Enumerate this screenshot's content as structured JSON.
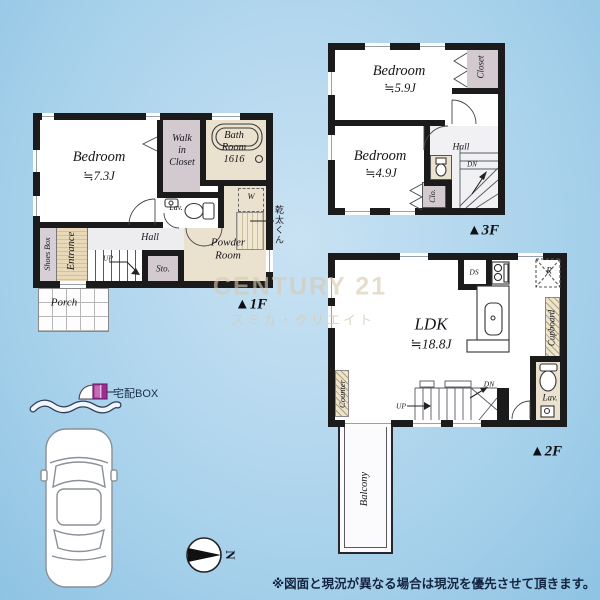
{
  "colors": {
    "background_top": "#b3d7ee",
    "background_bottom": "#8ec3e2",
    "wall": "#1b1b1b",
    "room_beige": "#eae2cf",
    "room_mauve": "#d3cad0",
    "hall_gray": "#ededf0",
    "watermark_beige": "#d8cab0",
    "delivery_magenta": "#9b2d93",
    "text_navy": "#152440"
  },
  "floors": {
    "f1": {
      "marker": "▲1F",
      "bedroom": [
        "Bedroom",
        "≒7.3J"
      ],
      "walk_in_closet": [
        "Walk",
        "in",
        "Closet"
      ],
      "bath": [
        "Bath",
        "Room",
        "1616"
      ],
      "lav": "Lav.",
      "washer": "W",
      "dryer": "乾太くん",
      "powder": [
        "Powder",
        "Room"
      ],
      "hall": "Hall",
      "up": "UP",
      "storage": "Sto.",
      "shoes_box": "Shoes Box",
      "entrance": "Entrance",
      "porch": "Porch"
    },
    "f3": {
      "marker": "▲3F",
      "bedroom1": [
        "Bedroom",
        "≒5.9J"
      ],
      "closet": "Closet",
      "bedroom2": [
        "Bedroom",
        "≒4.9J"
      ],
      "hall": "Hall",
      "dn": "DN",
      "clo": "Clo."
    },
    "f2": {
      "marker": "▲2F",
      "ldk": [
        "LDK",
        "≒18.8J"
      ],
      "ds": "DS",
      "fridge": "R",
      "cupboard": "Cupboard",
      "counter": "Counter",
      "up": "UP",
      "dn": "DN",
      "lav": "Lav.",
      "balcony": "Balcony"
    }
  },
  "watermark": {
    "brand": "CENTURY 21",
    "company": "スミカ・クリエイト"
  },
  "annotations": {
    "delivery_box": "宅配BOX",
    "compass_north": "N",
    "disclaimer": "※図面と現況が異なる場合は現況を優先させて頂きます。"
  }
}
